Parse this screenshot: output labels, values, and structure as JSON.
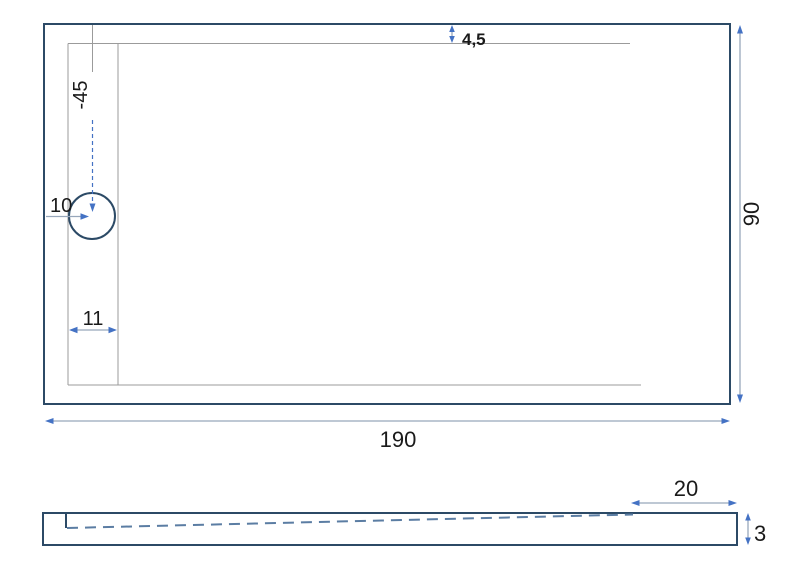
{
  "colors": {
    "outline": "#2c4a66",
    "dim-line": "#97a7bb",
    "thin-line": "#9b9b9b",
    "accent": "#4472c4",
    "dash": "#5b7da3",
    "text": "#1a1a1a",
    "bg": "#ffffff"
  },
  "top_view": {
    "dims": {
      "rim_offset_top": "4,5",
      "drain_depth": "-45",
      "drain_diameter": "10",
      "drain_margin_left": "11",
      "length": "190",
      "width": "90"
    }
  },
  "side_view": {
    "dims": {
      "flat_section": "20",
      "edge_thickness": "3"
    }
  }
}
